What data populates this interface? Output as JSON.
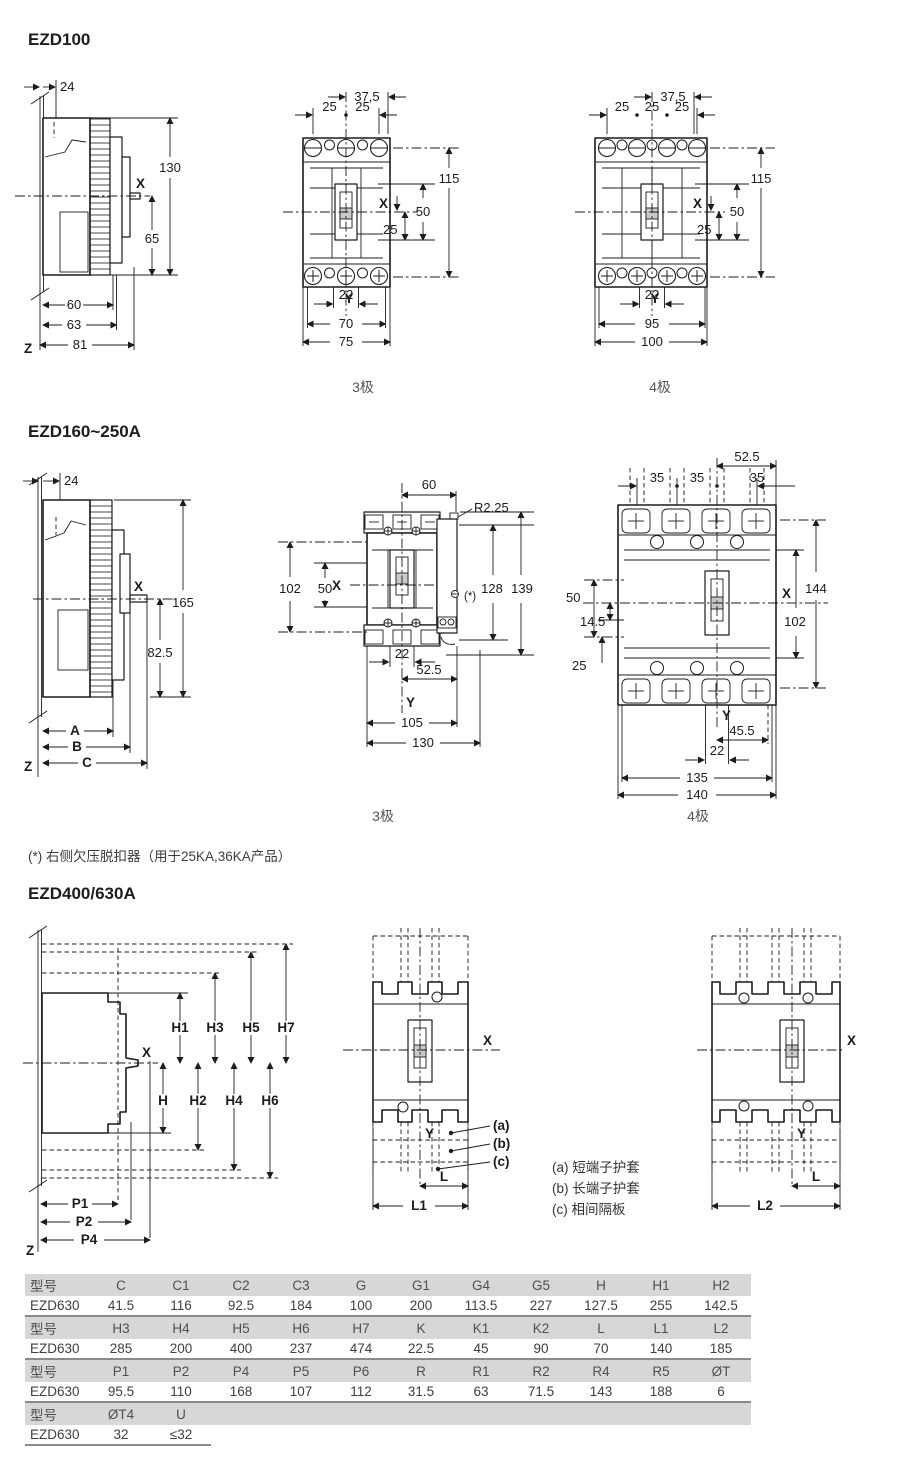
{
  "sections": {
    "ezd100": {
      "title": "EZD100"
    },
    "ezd160": {
      "title": "EZD160~250A"
    },
    "ezd400": {
      "title": "EZD400/630A"
    }
  },
  "captions": {
    "pole3": "3极",
    "pole4": "4极"
  },
  "footnote": "(*) 右侧欠压脱扣器（用于25KA,36KA产品）",
  "legend": {
    "a": "(a) 短端子护套",
    "b": "(b) 长端子护套",
    "c": "(c) 相间隔板"
  },
  "d100side": {
    "w24": "24",
    "h130": "130",
    "x": "X",
    "h65": "65",
    "b60": "60",
    "b63": "63",
    "b81": "81",
    "z": "Z"
  },
  "d100p3": {
    "t375": "37,5",
    "t25l": "25",
    "t25r": "25",
    "r115": "115",
    "x": "X",
    "r50": "50",
    "r25": "25",
    "y": "Y",
    "b22": "22",
    "b70": "70",
    "b75": "75"
  },
  "d100p4": {
    "t375": "37,5",
    "t25a": "25",
    "t25b": "25",
    "t25c": "25",
    "r115": "115",
    "x": "X",
    "r50": "50",
    "r25": "25",
    "y": "Y",
    "b22": "22",
    "b95": "95",
    "b100": "100"
  },
  "d160side": {
    "w24": "24",
    "h165": "165",
    "x": "X",
    "h825": "82.5",
    "a": "A",
    "b": "B",
    "c": "C",
    "z": "Z"
  },
  "d160p3": {
    "t60": "60",
    "r": "R2.25",
    "l102": "102",
    "l50": "50",
    "x": "X",
    "r128": "128",
    "r139": "139",
    "star": "(*)",
    "b22": "22",
    "b525": "52.5",
    "y": "Y",
    "b105": "105",
    "b130": "130"
  },
  "d160p4": {
    "t525": "52.5",
    "t35a": "35",
    "t35b": "35",
    "t35c": "35",
    "r144": "144",
    "r102": "102",
    "l50": "50",
    "l145": "14.5",
    "l25": "25",
    "x": "X",
    "y": "Y",
    "b455": "45.5",
    "b22": "22",
    "b135": "135",
    "b140": "140"
  },
  "d400side": {
    "h1": "H1",
    "h3": "H3",
    "h5": "H5",
    "h7": "H7",
    "x": "X",
    "h": "H",
    "h2": "H2",
    "h4": "H4",
    "h6": "H6",
    "p1": "P1",
    "p2": "P2",
    "p4": "P4",
    "z": "Z"
  },
  "d400p3": {
    "x": "X",
    "y": "Y",
    "la": "(a)",
    "lb": "(b)",
    "lc": "(c)",
    "l": "L",
    "l1": "L1"
  },
  "d400p4": {
    "x": "X",
    "y": "Y",
    "l": "L",
    "l2": "L2"
  },
  "table": {
    "rows": [
      {
        "h": [
          "型号",
          "C",
          "C1",
          "C2",
          "C3",
          "G",
          "G1",
          "G4",
          "G5",
          "H",
          "H1",
          "H2"
        ],
        "v": [
          "EZD630",
          "41.5",
          "116",
          "92.5",
          "184",
          "100",
          "200",
          "113.5",
          "227",
          "127.5",
          "255",
          "142.5"
        ]
      },
      {
        "h": [
          "型号",
          "H3",
          "H4",
          "H5",
          "H6",
          "H7",
          "K",
          "K1",
          "K2",
          "L",
          "L1",
          "L2"
        ],
        "v": [
          "EZD630",
          "285",
          "200",
          "400",
          "237",
          "474",
          "22.5",
          "45",
          "90",
          "70",
          "140",
          "185"
        ]
      },
      {
        "h": [
          "型号",
          "P1",
          "P2",
          "P4",
          "P5",
          "P6",
          "R",
          "R1",
          "R2",
          "R4",
          "R5",
          "ØT"
        ],
        "v": [
          "EZD630",
          "95.5",
          "110",
          "168",
          "107",
          "112",
          "31.5",
          "63",
          "71.5",
          "143",
          "188",
          "6"
        ]
      },
      {
        "h": [
          "型号",
          "ØT4",
          "U"
        ],
        "v": [
          "EZD630",
          "32",
          "≤32"
        ]
      }
    ]
  }
}
